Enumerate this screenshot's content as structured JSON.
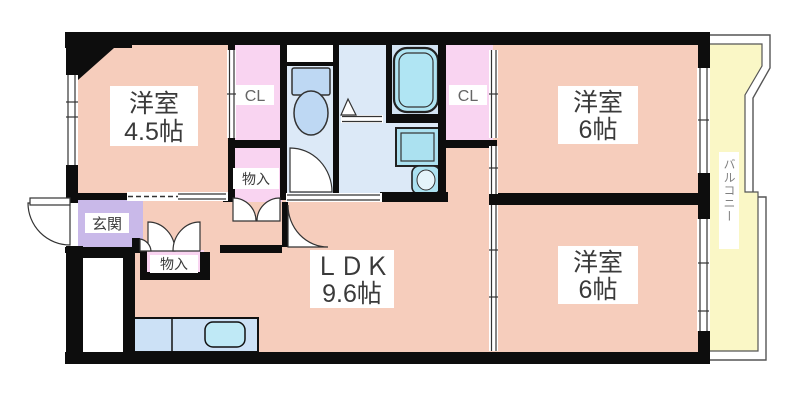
{
  "plan": {
    "type": "apartment-floor-plan",
    "labels": {
      "room_45": {
        "line1": "洋室",
        "line2": "4.5帖"
      },
      "room_6_top": {
        "line1": "洋室",
        "line2": "6帖"
      },
      "room_6_bottom": {
        "line1": "洋室",
        "line2": "6帖"
      },
      "ldk": {
        "line1": "ＬＤＫ",
        "line2": "9.6帖"
      },
      "entrance": "玄関",
      "closet_left": "CL",
      "closet_right": "CL",
      "storage_top": "物入",
      "storage_hall": "物入",
      "balcony": "バルコニー"
    },
    "colors": {
      "wall": "#0d0d0d",
      "room": "#f6cdbc",
      "closet": "#f9d4f1",
      "entrance": "#c9b9e9",
      "wet": "#dce9f7",
      "bath": "#d2e3f3",
      "tub": "#b0e5f3",
      "appliance": "#abe1f0",
      "toilet": "#bed8f3",
      "counter": "#cce1f6",
      "sink": "#bfe9f6",
      "balcony": "#faf7c6",
      "label_bg": "#ffffff",
      "door": "#ffffff"
    }
  }
}
